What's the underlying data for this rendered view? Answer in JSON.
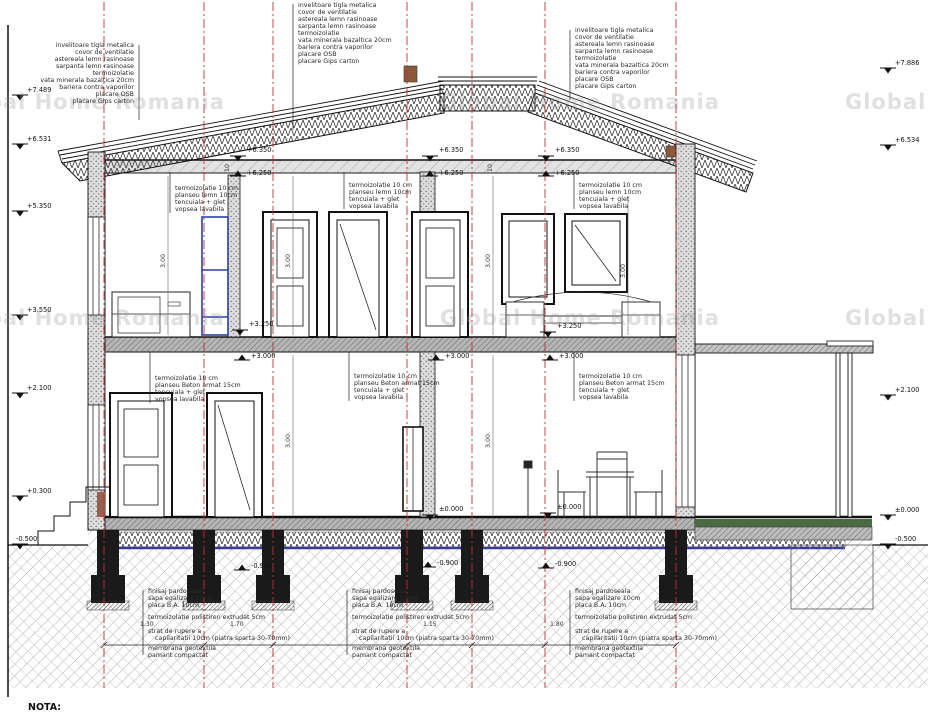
{
  "watermark": "Global Home Romania",
  "note_label": "NOTA:",
  "roof_layers": [
    "invelitoare tigla metalica",
    "covor de ventilatie",
    "astereala lemn rasinoase",
    "sarpanta lemn rasinoase",
    "termoizolatie",
    "vata minerala bazaltica 20cm",
    "bariera contra vaporilor",
    "placare OSB",
    "placare Gips carton"
  ],
  "attic_floor_layers": [
    "termoizolatie 10 cm",
    "planseu lemn 10cm",
    "tencuiala + glet",
    "vopsea lavabila"
  ],
  "slab_layers": [
    "termoizolatie 10 cm",
    "planseu Beton armat 15cm",
    "tencuiala + glet",
    "vopsea lavabila"
  ],
  "foundation_layers": [
    "finisaj pardoseala",
    "sapa egalizare 10cm",
    "placa B.A. 10cm",
    "termoizolatie polistiren extrudat 5cm",
    "strat de rupere a",
    "capilaritatii 10cm (piatra sparta 30-70mm)",
    "membrana geotextila",
    "pamant compactat"
  ],
  "elevations": {
    "left": [
      "+7.489",
      "+6.531",
      "+5.350",
      "+3.550",
      "+2.100",
      "+0.300",
      "-0.500"
    ],
    "right": [
      "+7.886",
      "+6.534",
      "+2.100",
      "±0.000",
      "-0.500"
    ],
    "attic_top": "+6.350",
    "attic_bottom": "+6.250",
    "floor_top": "+3.250",
    "floor_bottom": "+3.000",
    "ground": "±0.000",
    "foundation_base": "-0.900"
  },
  "dims": {
    "room_height": "3.00",
    "slab_thickness": "10",
    "foundation_segments": [
      "1.30",
      "1.70",
      "1.15",
      "1.80"
    ]
  }
}
